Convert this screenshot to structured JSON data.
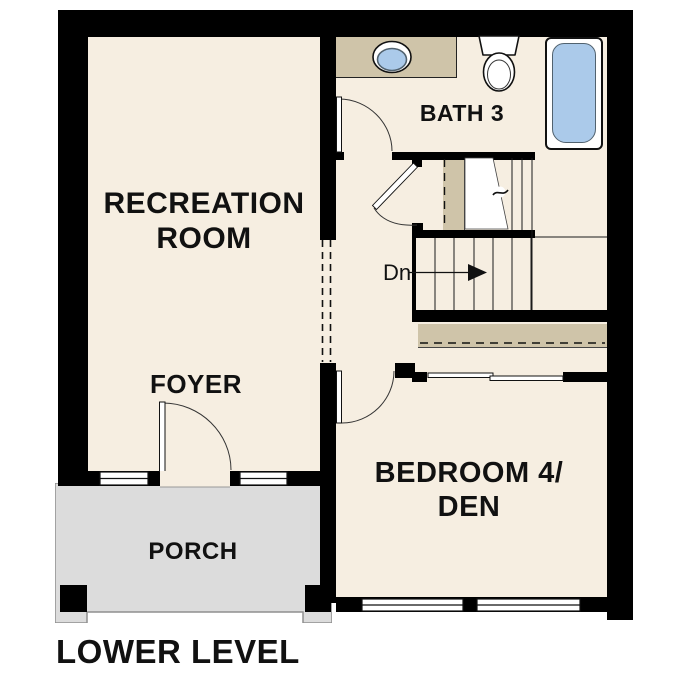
{
  "title": {
    "label": "LOWER LEVEL"
  },
  "rooms": {
    "recreation": {
      "label": "RECREATION\nROOM"
    },
    "foyer": {
      "label": "FOYER"
    },
    "bath3": {
      "label": "BATH 3"
    },
    "bedroom4": {
      "label": "BEDROOM 4/\nDEN"
    },
    "porch": {
      "label": "PORCH"
    }
  },
  "stairs": {
    "direction_label": "Dn"
  },
  "fixtures": [
    "vanity-sink",
    "toilet",
    "bathtub"
  ],
  "colors": {
    "wall": "#000000",
    "floor": "#f6eee1",
    "tan": "#cfc4a9",
    "blue": "#abcaea",
    "blue_border": "#51626f",
    "porch": "#dcdcdc",
    "porch_border": "#8f8f8f",
    "line": "#1a1a1a"
  }
}
